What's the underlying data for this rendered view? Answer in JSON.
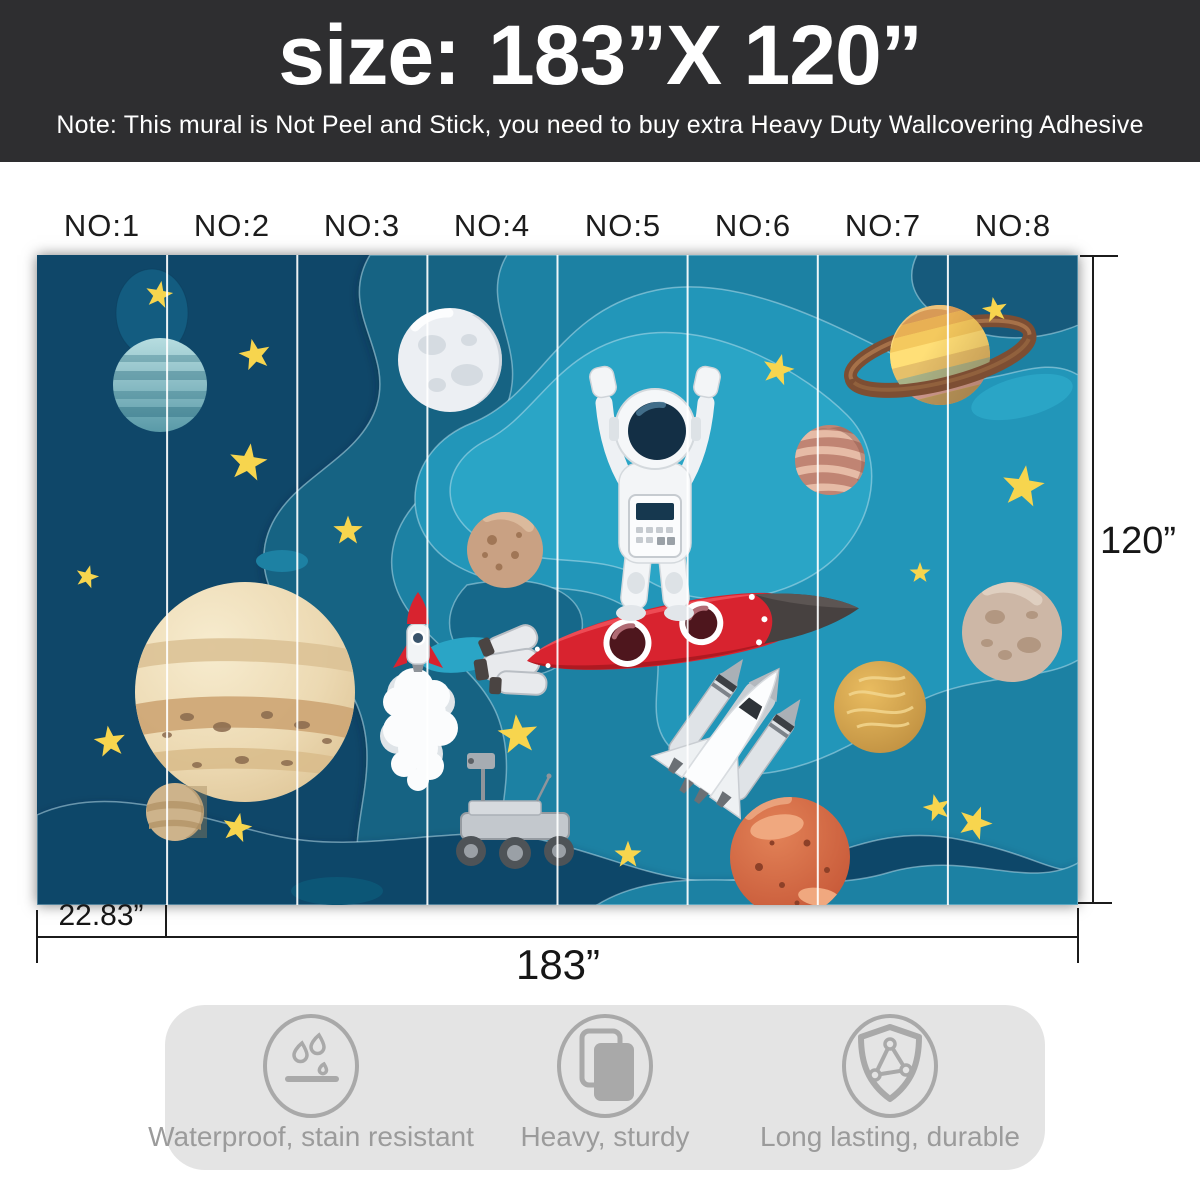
{
  "header": {
    "title_label": "size:",
    "title_value": "183”X 120”",
    "note": "Note: This mural is Not Peel and Stick, you need to buy extra Heavy Duty Wallcovering Adhesive"
  },
  "panels": {
    "count": 8,
    "labels": [
      "NO:1",
      "NO:2",
      "NO:3",
      "NO:4",
      "NO:5",
      "NO:6",
      "NO:7",
      "NO:8"
    ]
  },
  "dimensions": {
    "panel_width": "22.83”",
    "total_width": "183”",
    "height": "120”"
  },
  "features": {
    "items": [
      {
        "icon": "waterproof-icon",
        "label": "Waterproof, stain resistant"
      },
      {
        "icon": "stack-icon",
        "label": "Heavy, sturdy"
      },
      {
        "icon": "shield-icon",
        "label": "Long lasting, durable"
      }
    ]
  },
  "colors": {
    "header_bg": "#2e2e30",
    "header_text": "#ffffff",
    "label_text": "#1c1c1c",
    "dimension_line": "#1b1b1b",
    "mural_navy": "#0f4769",
    "mural_teal": "#2496b9",
    "star_yellow": "#f7d54e",
    "rocket_red": "#d8232f",
    "features_bg": "#e4e4e4",
    "features_gray": "#9b9b9b"
  }
}
